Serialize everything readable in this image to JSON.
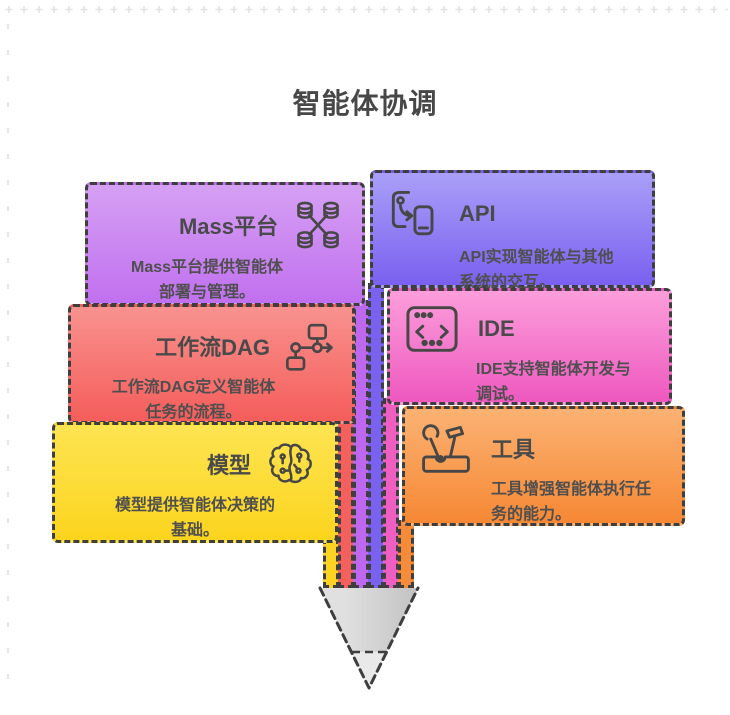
{
  "page": {
    "title": "智能体协调"
  },
  "decor": {
    "plus_mark_color": "#e2e2e2",
    "border_color": "#3e3e3e",
    "text_color": "#4a4a4a"
  },
  "cards": {
    "mass": {
      "title": "Mass平台",
      "desc1": "Mass平台提供智能体",
      "desc2": "部署与管理。",
      "icon": "database-cluster-icon",
      "color_top": "#d5a0f3",
      "color_bottom": "#c170ef",
      "stripe": "#bd68ee"
    },
    "api": {
      "title": "API",
      "desc1": "API实现智能体与其他",
      "desc2": "系统的交互。",
      "icon": "device-transfer-icon",
      "color_top": "#a99ff8",
      "color_bottom": "#7a60ef",
      "stripe": "#7b61f0"
    },
    "dag": {
      "title": "工作流DAG",
      "desc1": "工作流DAG定义智能体",
      "desc2": "任务的流程。",
      "icon": "workflow-dag-icon",
      "color_top": "#f9928f",
      "color_bottom": "#f45d5a",
      "stripe": "#f4605d"
    },
    "ide": {
      "title": "IDE",
      "desc1": "IDE支持智能体开发与",
      "desc2": "调试。",
      "icon": "code-editor-icon",
      "color_top": "#fc9edb",
      "color_bottom": "#ee58bf",
      "stripe": "#ef5fc2"
    },
    "model": {
      "title": "模型",
      "desc1": "模型提供智能体决策的",
      "desc2": "基础。",
      "icon": "brain-icon",
      "color_top": "#fde452",
      "color_bottom": "#fbd41d",
      "stripe": "#fcd322"
    },
    "tool": {
      "title": "工具",
      "desc1": "工具增强智能体执行任",
      "desc2": "务的能力。",
      "icon": "toolbox-icon",
      "color_top": "#fbb273",
      "color_bottom": "#f68834",
      "stripe": "#f68b3a"
    }
  },
  "pencil": {
    "cone_light": "#e0e0e0",
    "cone_dark": "#c2c2c2",
    "lead_color": "#e9e9e9",
    "outline": "#3e3e3e"
  }
}
